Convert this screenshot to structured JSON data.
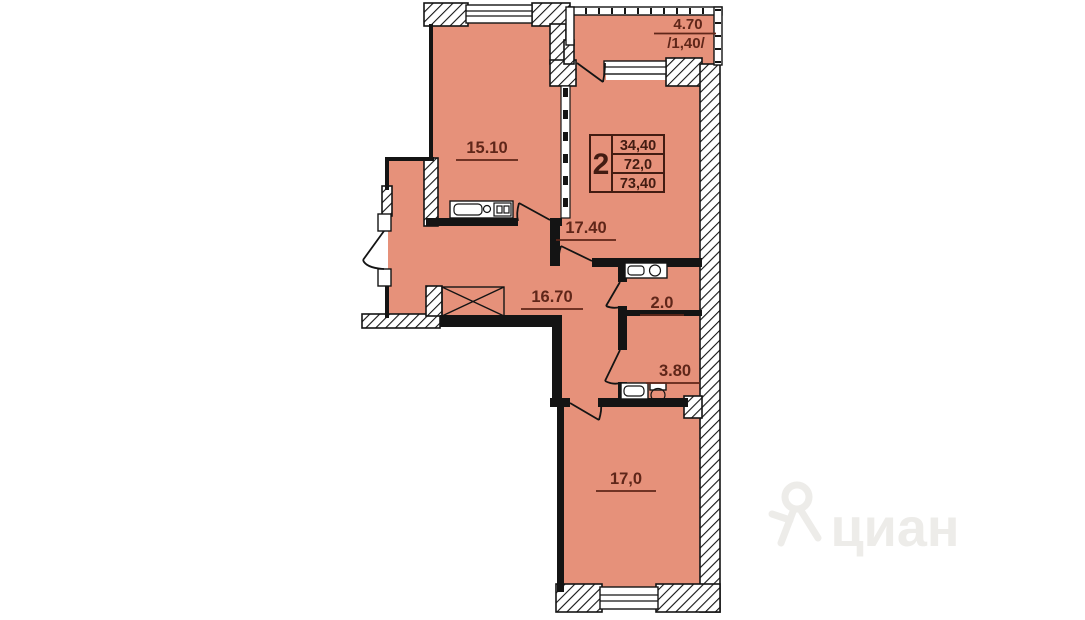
{
  "plan": {
    "info_box": {
      "rooms_count": "2",
      "row1": "34,40",
      "row2": "72,0",
      "row3": "73,40"
    },
    "labels": {
      "kitchen": "15.10",
      "living": "17.40",
      "hall": "16.70",
      "wc": "2.0",
      "bathroom": "3.80",
      "bedroom": "17,0",
      "balcony_area": "4.70",
      "balcony_reduced": "/1,40/"
    },
    "watermark": "циан",
    "colors": {
      "room_fill": "#e6917a",
      "wall": "#141414",
      "label_text": "#5f2619",
      "info_text": "#431c12",
      "watermark": "#edece9"
    }
  }
}
